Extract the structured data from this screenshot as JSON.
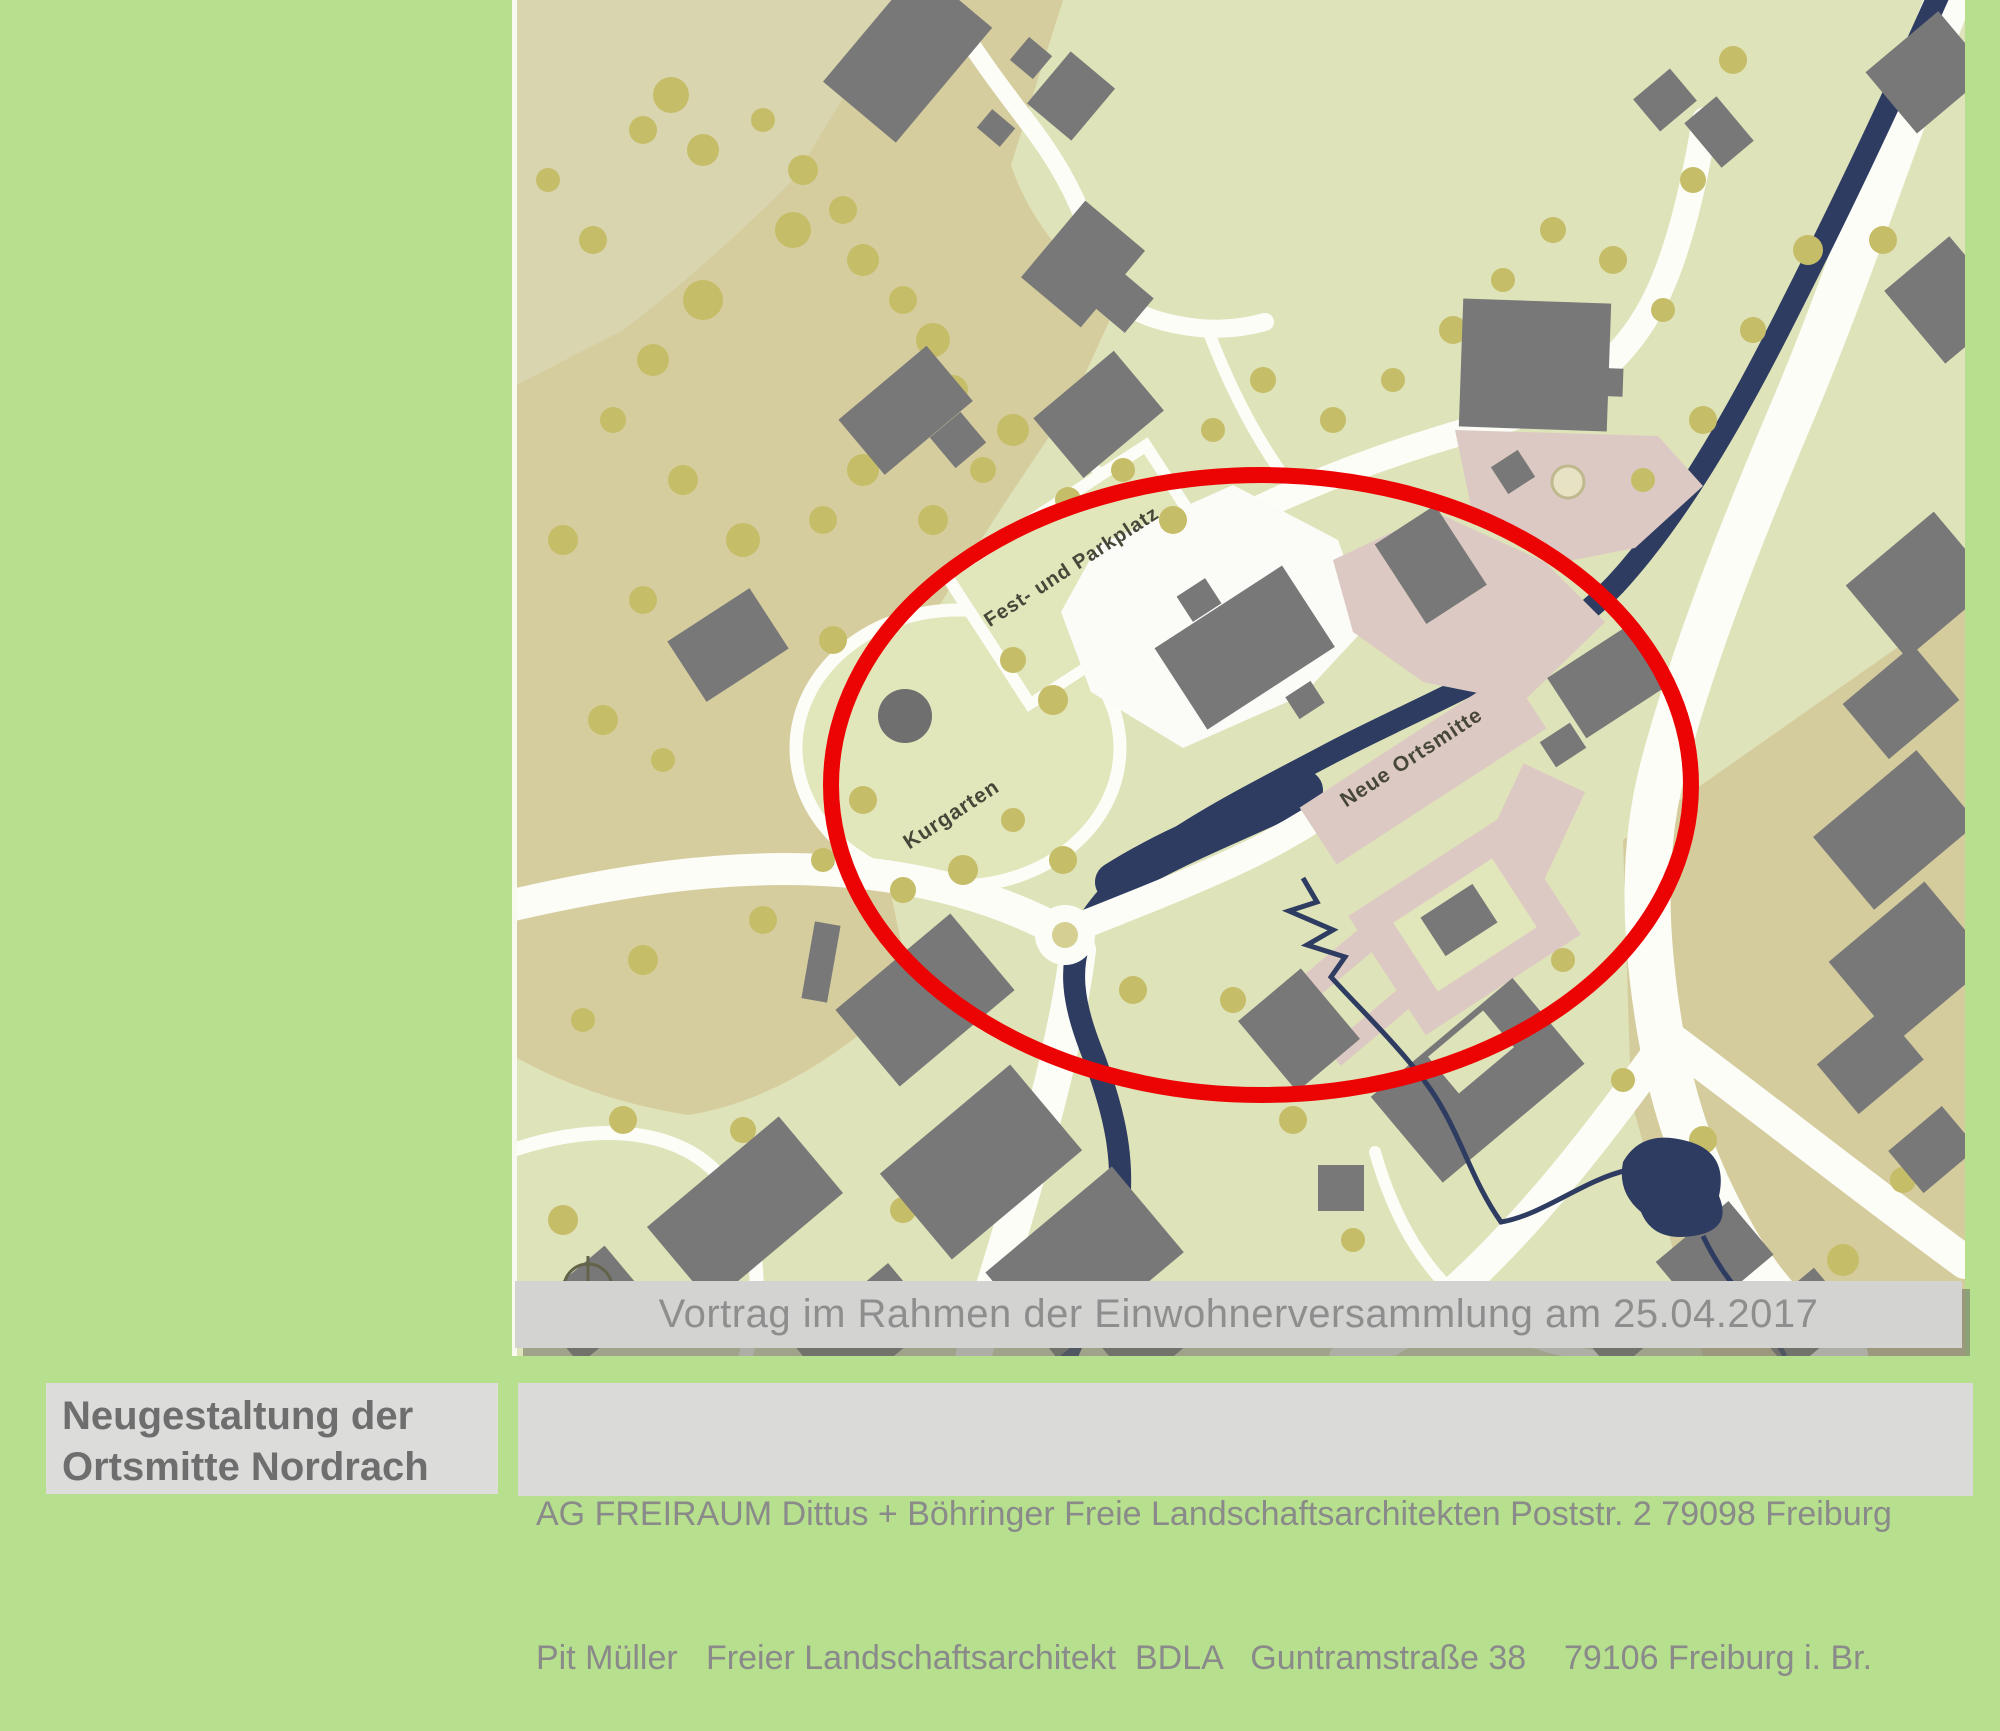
{
  "slide": {
    "background_color": "#b6e08d",
    "caption": "Vortrag im Rahmen der Einwohnerversammlung am 25.04.2017",
    "title": {
      "line1": "Neugestaltung der",
      "line2": "Ortsmitte Nordrach"
    },
    "credits": {
      "line1": "AG FREIRAUM Dittus + Böhringer Freie Landschaftsarchitekten Poststr. 2 79098 Freiburg",
      "line2": "Pit Müller   Freier Landschaftsarchitekt  BDLA   Guntramstraße 38    79106 Freiburg i. Br."
    }
  },
  "map": {
    "type": "site-plan",
    "labels": {
      "fest_parkplatz": "Fest- und Parkplatz",
      "kurgarten": "Kurgarten",
      "neue_ortsmitte": "Neue Ortsmitte"
    },
    "highlight": {
      "shape": "ellipse",
      "color": "#ec0404"
    },
    "colors": {
      "base_green": "#dfe3b9",
      "tan": "#d6cd9f",
      "building_gray": "#787878",
      "river_navy": "#2e3c62",
      "road_white": "#fdfdf8",
      "plaza_pink": "#ddc9c3",
      "tree_olive": "#c6bd68"
    }
  }
}
